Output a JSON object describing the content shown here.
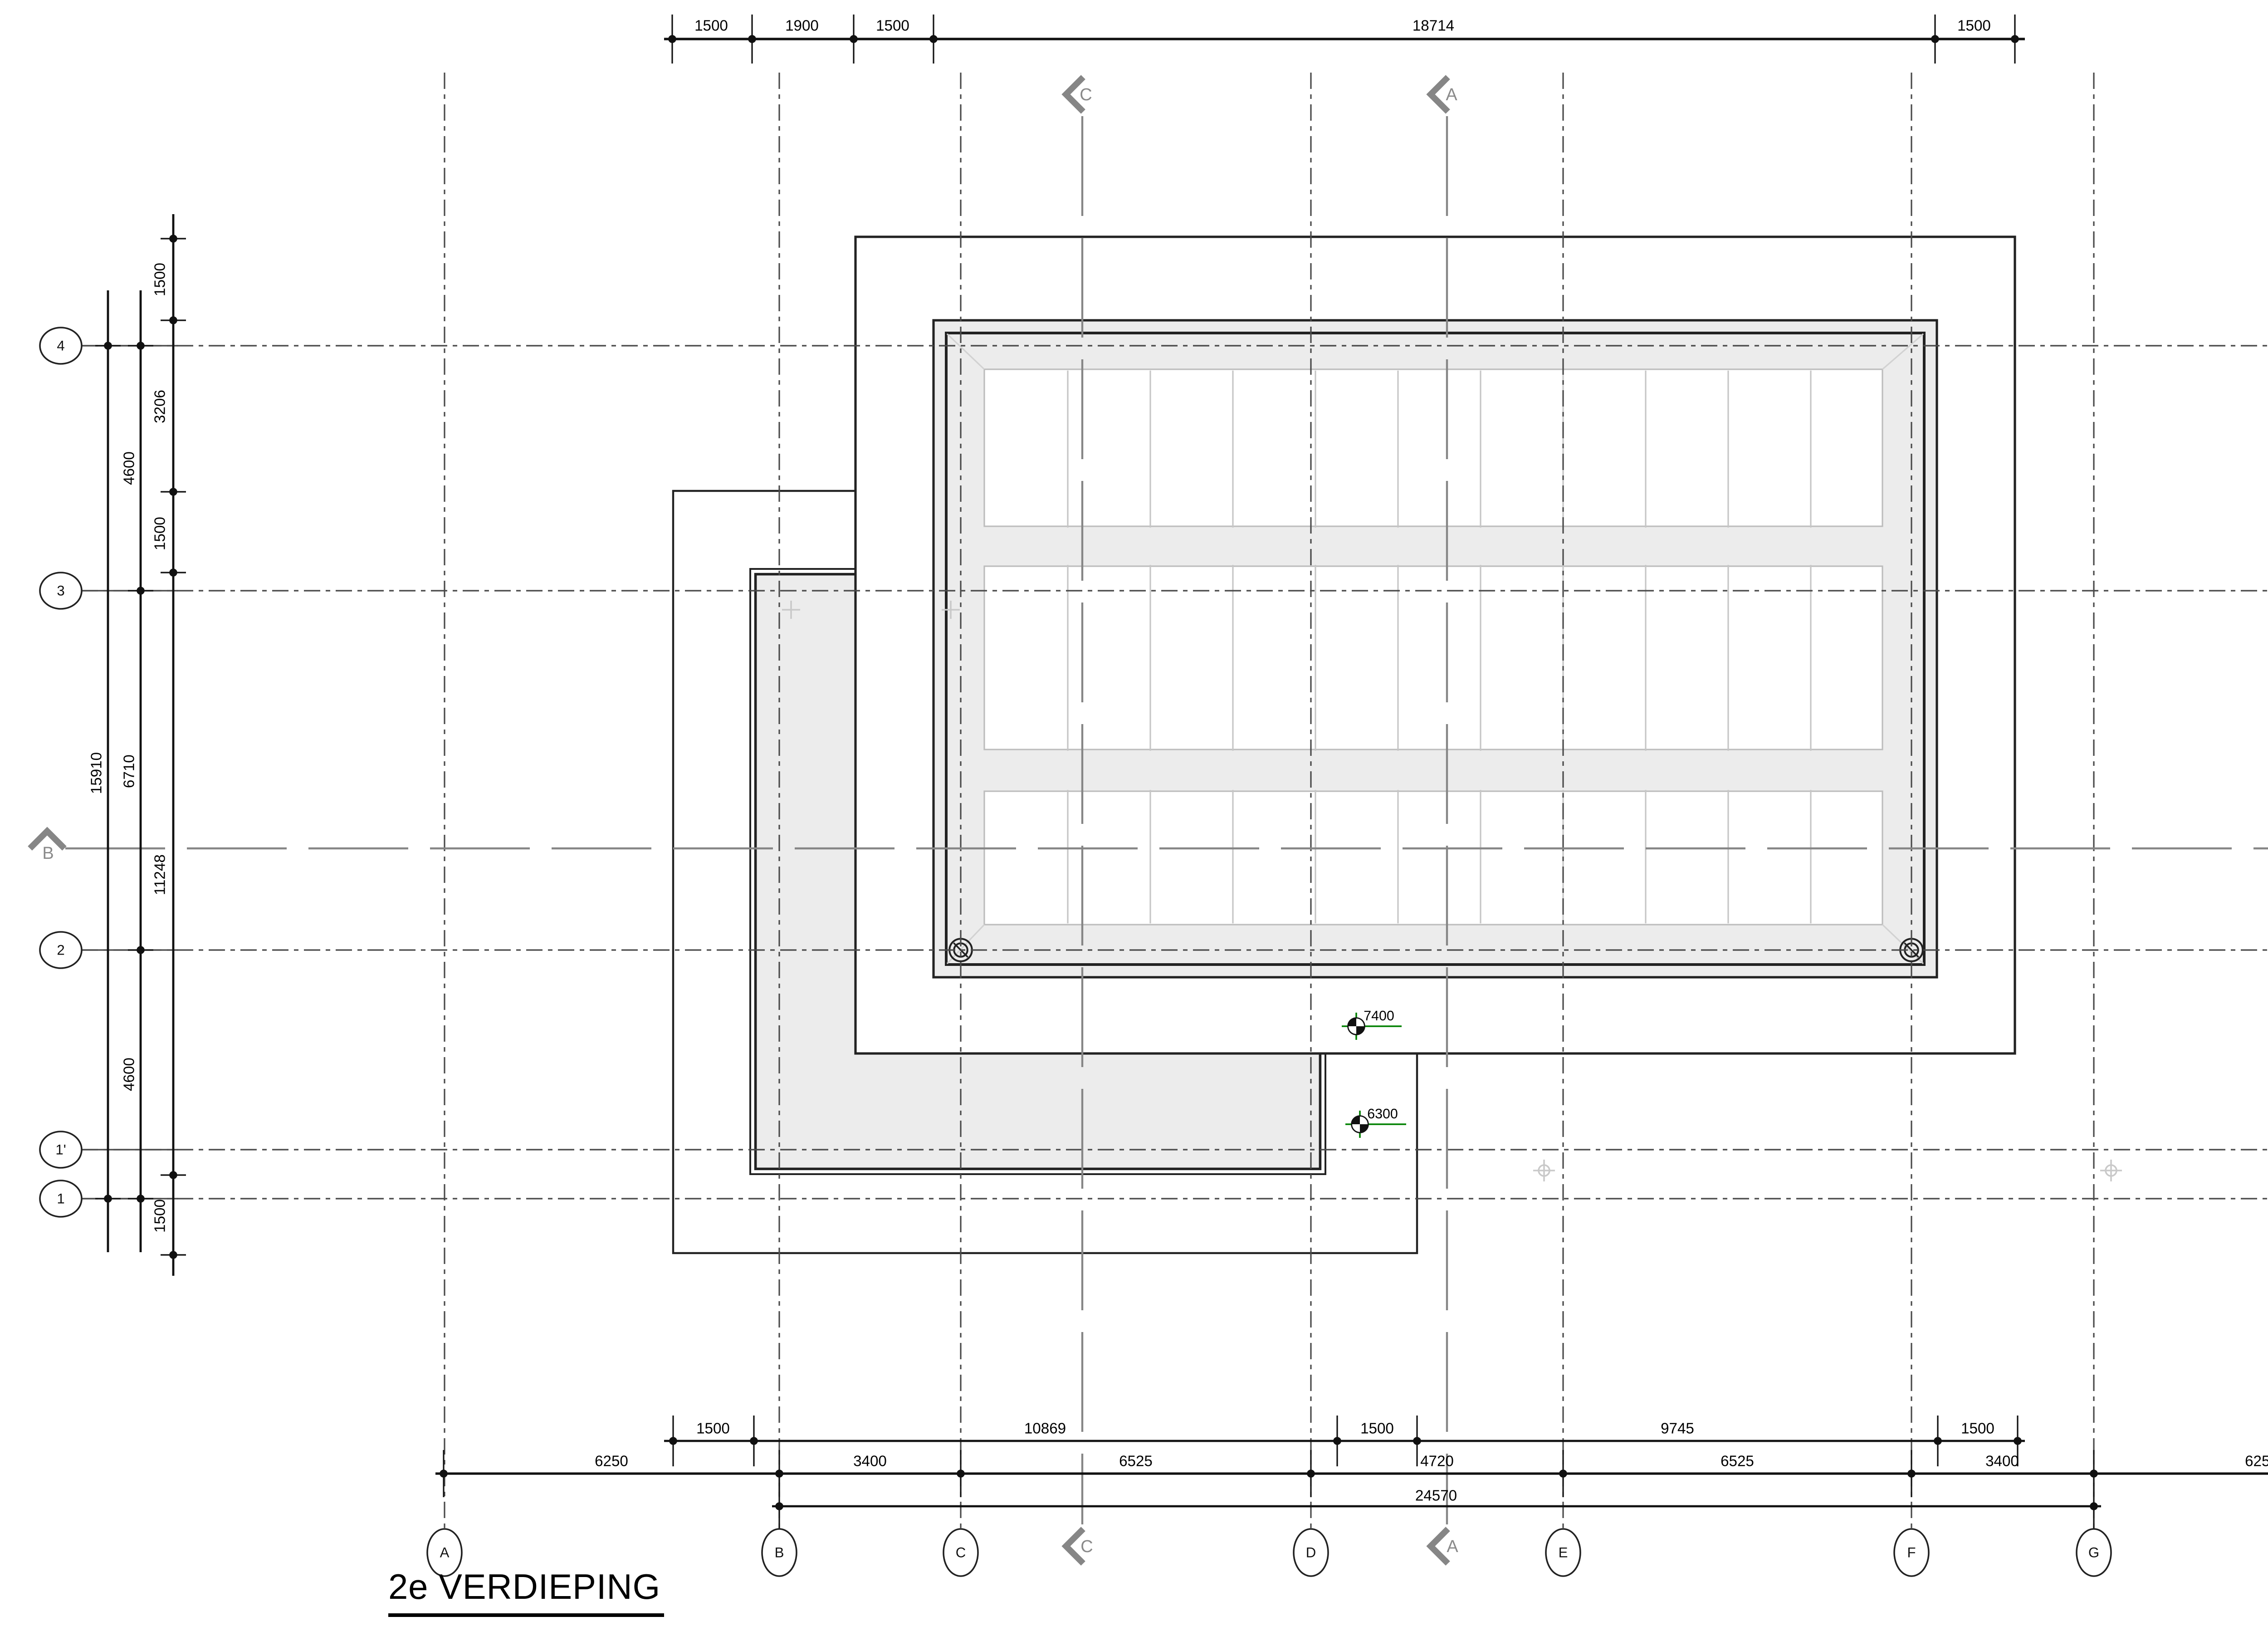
{
  "title": "2e VERDIEPING",
  "grid_columns": [
    "A",
    "B",
    "C",
    "D",
    "E",
    "F",
    "G",
    "H"
  ],
  "grid_rows": [
    "4",
    "3",
    "2",
    "1'",
    "1"
  ],
  "dims_top": [
    "1500",
    "1900",
    "1500",
    "18714",
    "1500"
  ],
  "dims_left_inner": [
    "1500",
    "3206",
    "1500",
    "11248",
    "1500"
  ],
  "dims_left_mid": [
    "4600",
    "6710",
    "4600"
  ],
  "dims_left_outer": [
    "15910"
  ],
  "dims_right": [
    "1500",
    "12254",
    "1500",
    "2200",
    "1500"
  ],
  "dims_bottom_detail": [
    "1500",
    "10869",
    "1500",
    "9745",
    "1500"
  ],
  "dims_bottom_grid": [
    "6250",
    "3400",
    "6525",
    "4720",
    "6525",
    "3400",
    "6250"
  ],
  "dims_bottom_total": "24570",
  "levels": [
    "7400",
    "6300"
  ],
  "sections": {
    "vertical_1": "C",
    "vertical_2": "A",
    "horizontal": "B"
  },
  "colors": {
    "line": "#1f1f1f",
    "grid_line": "#4a4a4a",
    "section_gray": "#868686",
    "roof_fill": "#ececec",
    "panel_line": "#bdbdbd",
    "level_green": "#008000",
    "mark_gray": "#c9c9c9"
  }
}
